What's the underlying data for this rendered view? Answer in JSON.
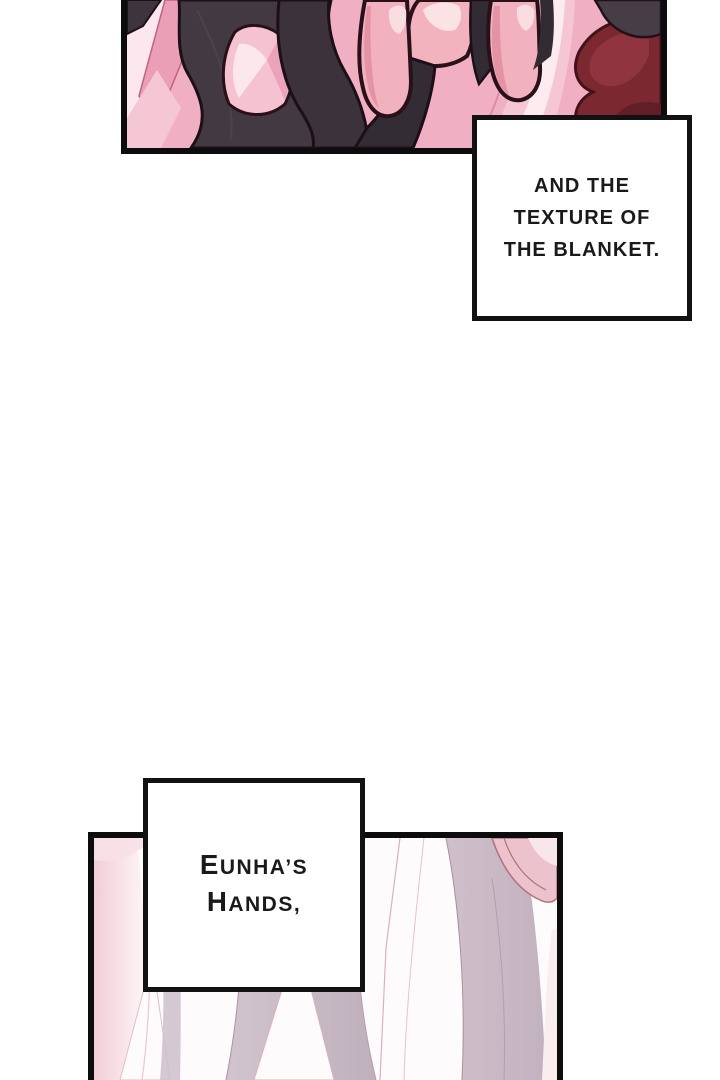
{
  "page": {
    "kind": "webtoon-comic-page",
    "background_color": "#ffffff"
  },
  "captions": {
    "blanket": {
      "lines": [
        "AND THE",
        "TEXTURE OF",
        "THE BLANKET."
      ],
      "text": "AND THE TEXTURE OF THE BLANKET."
    },
    "hands": {
      "lines": [
        "EUNHA’S",
        "HANDS,"
      ],
      "text": "EUNHA’S HANDS,"
    }
  },
  "panels": {
    "top": {
      "alt": "Fingers gripping a blanket with dark and pink fabric folds"
    },
    "bottom": {
      "alt": "Soft pink and mauve bed-sheet folds"
    }
  },
  "colors": {
    "caption_text": "#1b191a",
    "caption_background": "#ffffff",
    "caption_border": "#121212",
    "panel_border": "#0c0c0c",
    "blanket_pink": "#f1afc3",
    "blanket_pink_light": "#fbe7ed",
    "blanket_dark_fabric": "#3b323b",
    "blanket_maroon": "#7b2830",
    "skin_pink": "#f2b1be",
    "skin_highlight": "#fadde0",
    "sheet_mauve": "#c8b9c4",
    "sheet_pink": "#f5d9e0"
  }
}
